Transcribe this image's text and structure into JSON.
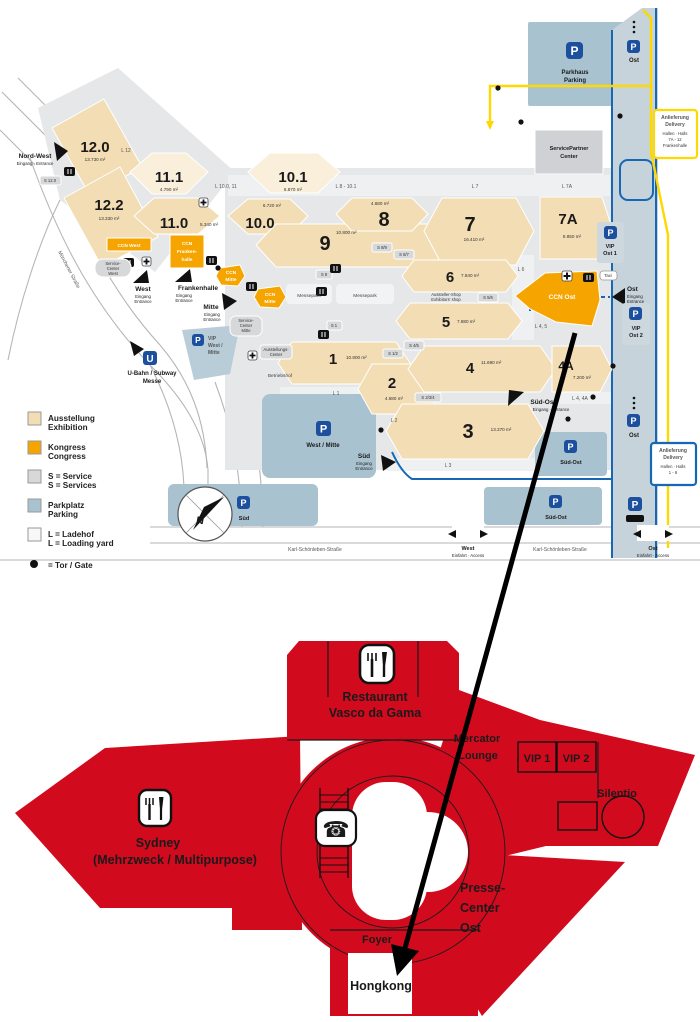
{
  "map": {
    "halls": [
      {
        "id": "12.0",
        "area": "13.730 m²"
      },
      {
        "id": "12.2",
        "area": "13.330 m²"
      },
      {
        "id": "11.1",
        "area": "4.790 m²"
      },
      {
        "id": "11.0",
        "area": "5.340 m²"
      },
      {
        "id": "10.1",
        "area": "6.870 m²"
      },
      {
        "id": "10.0",
        "area": "6.720 m²"
      },
      {
        "id": "9",
        "area": "10.800 m²"
      },
      {
        "id": "8",
        "area": "4.680 m²"
      },
      {
        "id": "7",
        "area": "16.410 m²"
      },
      {
        "id": "7A",
        "area": "8.850 m²"
      },
      {
        "id": "6",
        "area": "7.840 m²"
      },
      {
        "id": "5",
        "area": "7.880 m²"
      },
      {
        "id": "4",
        "area": "11.690 m²"
      },
      {
        "id": "4A",
        "area": "7.200 m²"
      },
      {
        "id": "3",
        "area": "13.370 m²"
      },
      {
        "id": "2",
        "area": "4.680 m²"
      },
      {
        "id": "1",
        "area": "10.800 m²"
      }
    ],
    "ccn": {
      "west": "CCN West",
      "fh_l1": "CCN",
      "fh_l2": "Franken-",
      "fh_l3": "halle",
      "mitte_l1": "CCN",
      "mitte_l2": "Mitte",
      "ost": "CCN Ost"
    },
    "entrances": {
      "nordwest": {
        "name": "Nord-West",
        "sub": "Eingang · Entrance"
      },
      "west": {
        "name": "West",
        "sub1": "Eingang",
        "sub2": "Entrance"
      },
      "frankenhalle": {
        "name": "Frankenhalle",
        "sub1": "Eingang",
        "sub2": "Entrance"
      },
      "mitte": {
        "name": "Mitte",
        "sub1": "Eingang",
        "sub2": "Entrance"
      },
      "sued": {
        "name": "Süd",
        "sub1": "Eingang",
        "sub2": "Entrance"
      },
      "suedost": {
        "name": "Süd-Ost",
        "sub": "Eingang · Entrance"
      },
      "ost": {
        "name": "Ost",
        "sub1": "Eingang",
        "sub2": "Entrance"
      }
    },
    "lyards": {
      "l12": "L 12",
      "l10": "L 10.0, 11",
      "l8": "L 8 - 10.1",
      "l7": "L 7",
      "l7a": "L 7A",
      "l6": "L 6",
      "l45": "L 4, 5",
      "l44a": "L 4, 4A",
      "l1": "L 1",
      "l2": "L 2",
      "l3": "L 3"
    },
    "services": {
      "s12": "S 12.0",
      "s89": "S 8/9",
      "s67": "S 6/7",
      "s9": "S 9",
      "s56": "S 5/6",
      "s45": "S 4/5",
      "s12b": "S 1/2",
      "s1": "S 1",
      "s234": "S 2/3/4"
    },
    "parking": {
      "parkhaus_l1": "Parkhaus",
      "parkhaus_l2": "Parking",
      "ost_top": "Ost",
      "vipost1_l1": "VIP",
      "vipost1_l2": "Ost 1",
      "vipost2_l1": "VIP",
      "vipost2_l2": "Ost 2",
      "ost_mid": "Ost",
      "suedost_up": "Süd-Ost",
      "suedost_low": "Süd-Ost",
      "sued": "Süd",
      "westmitte": "West / Mitte",
      "vipwest_l1": "VIP",
      "vipwest_l2": "West /",
      "vipwest_l3": "Mitte"
    },
    "facilities": {
      "spc_l1": "ServicePartner",
      "spc_l2": "Center",
      "scw_l1": "Service-",
      "scw_l2": "Center",
      "scw_l3": "West",
      "scm_l1": "Service-",
      "scm_l2": "Center",
      "scm_l3": "Mitte",
      "ac_l1": "Ausstellungs-",
      "ac_l2": "Center",
      "shop_l1": "Aussteller-Shop",
      "shop_l2": "Exhibitors' shop",
      "ubahn_l1": "U-Bahn / Subway",
      "ubahn_l2": "Messe",
      "betriebshof": "Betriebshof",
      "messepark": "Messepark",
      "taxi": "Taxi"
    },
    "delivery1": {
      "l1": "Anlieferung",
      "l2": "Delivery",
      "l3": "Hallen · Halls",
      "l4": "7A - 12",
      "l5": "Frankenhalle"
    },
    "delivery2": {
      "l1": "Anlieferung",
      "l2": "Delivery",
      "l3": "Hallen · Halls",
      "l4": "1 - 6"
    },
    "streets": {
      "muenchener": "Münchener Straße",
      "otto": "Otto-Bärnreuther-Straße",
      "karl": "Karl-Schönleben-Straße"
    },
    "access": {
      "west": "West",
      "ost": "Ost",
      "sub": "Einfahrt · Access"
    },
    "legend": {
      "r1a": "Ausstellung",
      "r1b": "Exhibition",
      "r2a": "Kongress",
      "r2b": "Congress",
      "r3a": "S = Service",
      "r3b": "S = Services",
      "r4a": "Parkplatz",
      "r4b": "Parking",
      "r5a": "L = Ladehof",
      "r5b": "L = Loading yard",
      "r6": "= Tor / Gate"
    },
    "compass": "N"
  },
  "plan": {
    "restaurant_l1": "Restaurant",
    "restaurant_l2": "Vasco da Gama",
    "mercator_l1": "Mercator",
    "mercator_l2": "Lounge",
    "vip1": "VIP 1",
    "vip2": "VIP 2",
    "silentio": "Silentio",
    "sydney_l1": "Sydney",
    "sydney_l2": "(Mehrzweck / Multipurpose)",
    "presse_l1": "Presse-",
    "presse_l2": "Center",
    "presse_l3": "Ost",
    "foyer": "Foyer",
    "hongkong": "Hongkong"
  },
  "icons": {
    "p": "P",
    "u": "U",
    "phone": "☎"
  },
  "colors": {
    "exhibition": "#f3ddb4",
    "exhibition_light": "#f9efda",
    "congress": "#f6a500",
    "service": "#d7d8da",
    "parking": "#a9c2cf",
    "loading": "#f0f1f2",
    "red": "#d20a1e",
    "route_yellow": "#ffd800",
    "route_blue": "#1668b4",
    "p_blue": "#1d4f9f"
  }
}
